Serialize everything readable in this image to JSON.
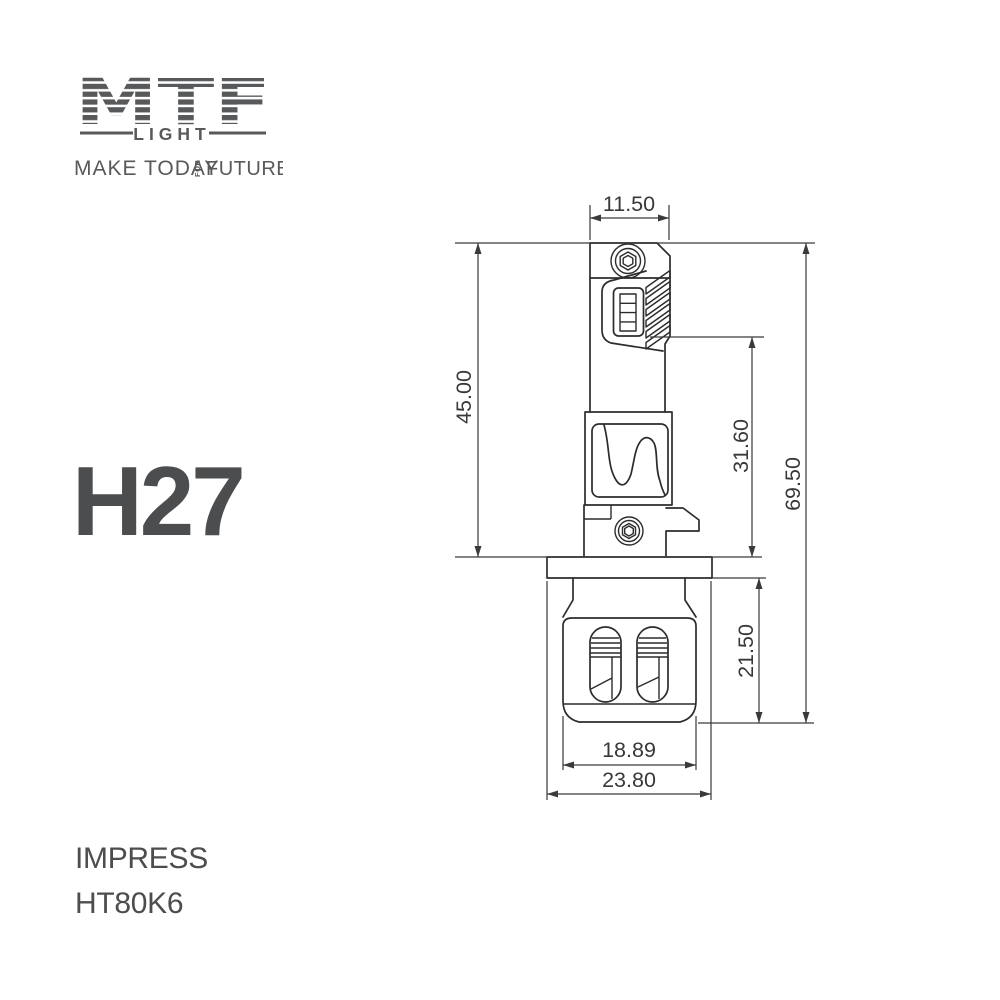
{
  "brand": {
    "name": "MTF",
    "sub": "LIGHT",
    "tagline_a": "MAKE TODAY",
    "tagline_mid": "FOR",
    "tagline_b": "FUTURE"
  },
  "product": {
    "model": "H27",
    "series": "IMPRESS",
    "sku": "HT80K6"
  },
  "drawing": {
    "type": "led-bulb-dimension-drawing",
    "units_implied": "mm",
    "dims": {
      "top_width": "11.50",
      "upper_height": "45.00",
      "mid_height": "31.60",
      "total_height": "69.50",
      "base_height": "21.50",
      "body_width": "18.89",
      "flange_width": "23.80"
    }
  },
  "colors": {
    "background": "#ffffff",
    "brand_gray": "#58595b",
    "text_dark": "#4c4d4f",
    "line_dark": "#2c2c2c",
    "dim_line": "#3a3a3a"
  }
}
